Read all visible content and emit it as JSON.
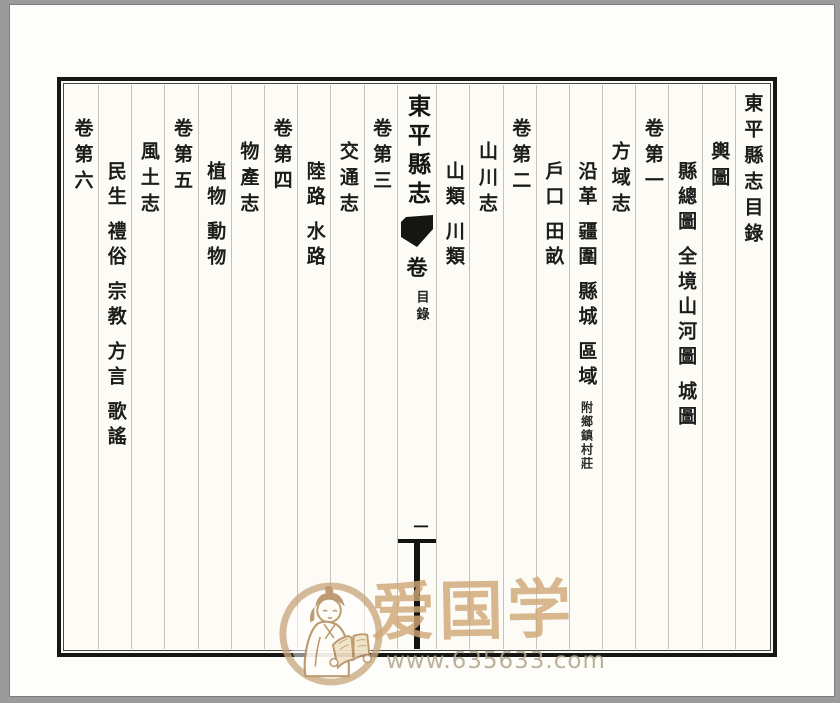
{
  "book": {
    "toc_title": "東平縣志目錄",
    "columns": [
      {
        "level": "section",
        "groups": [
          "輿圖"
        ]
      },
      {
        "level": "items",
        "groups": [
          "縣總圖",
          "全境山河圖",
          "城圖"
        ]
      },
      {
        "level": "volume",
        "groups": [
          "卷第一"
        ]
      },
      {
        "level": "section",
        "groups": [
          "方域志"
        ]
      },
      {
        "level": "items",
        "groups": [
          "沿革",
          "疆圍",
          "縣城",
          "區域"
        ],
        "note": "附鄉鎮村莊"
      },
      {
        "level": "items",
        "groups": [
          "戶口",
          "田畝"
        ]
      },
      {
        "level": "volume",
        "groups": [
          "卷第二"
        ]
      },
      {
        "level": "section",
        "groups": [
          "山川志"
        ]
      },
      {
        "level": "items",
        "groups": [
          "山類",
          "川類"
        ]
      },
      {
        "level": "volume",
        "groups": [
          "卷第三"
        ]
      },
      {
        "level": "section",
        "groups": [
          "交通志"
        ]
      },
      {
        "level": "items",
        "groups": [
          "陸路",
          "水路"
        ]
      },
      {
        "level": "volume",
        "groups": [
          "卷第四"
        ]
      },
      {
        "level": "section",
        "groups": [
          "物產志"
        ]
      },
      {
        "level": "items",
        "groups": [
          "植物",
          "動物"
        ]
      },
      {
        "level": "volume",
        "groups": [
          "卷第五"
        ]
      },
      {
        "level": "section",
        "groups": [
          "風土志"
        ]
      },
      {
        "level": "items",
        "groups": [
          "民生",
          "禮俗",
          "宗教",
          "方言",
          "歌謠"
        ]
      },
      {
        "level": "volume",
        "groups": [
          "卷第六"
        ]
      }
    ]
  },
  "banxin": {
    "title": "東平縣志",
    "volume_label": "卷",
    "section_label": "目錄",
    "page_number": "一"
  },
  "watermark": {
    "brand": "爱国学",
    "url": "www.635633.com",
    "badge_icon": "scholar-reading-book-icon"
  },
  "colors": {
    "frame_ink": "#161614",
    "paper": "#fdfdfa",
    "scan_background": "#9b9b9b",
    "watermark_tan": "#cfa776"
  }
}
